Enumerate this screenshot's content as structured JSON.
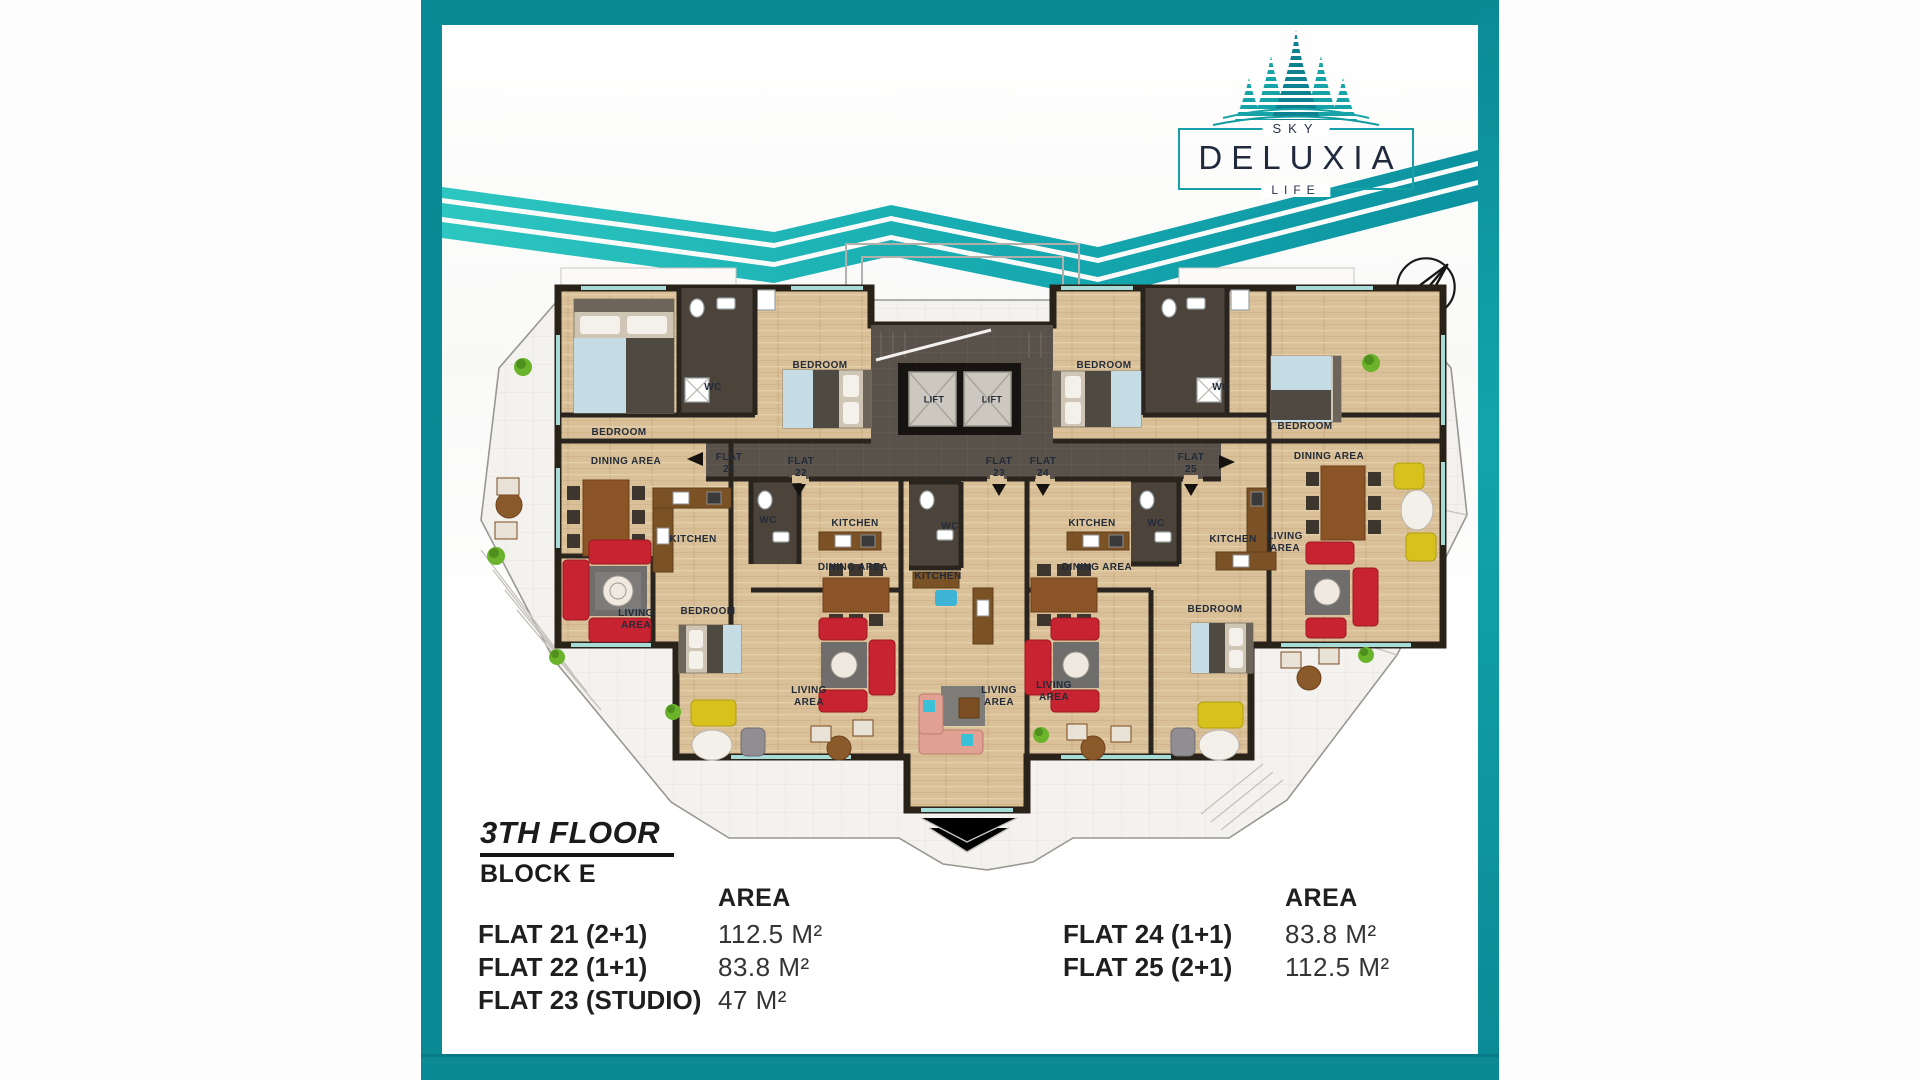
{
  "logo": {
    "sky": "SKY",
    "name": "DELUXIA",
    "life": "LIFE"
  },
  "floor_info": {
    "floor_label": "3TH FLOOR",
    "block_label": "BLOCK E"
  },
  "area_tables": {
    "left": {
      "header": "AREA",
      "rows": [
        {
          "flat": "FLAT 21 (2+1)",
          "area": "112.5 M²"
        },
        {
          "flat": "FLAT 22 (1+1)",
          "area": "83.8 M²"
        },
        {
          "flat": "FLAT 23 (STUDIO)",
          "area": "47 M²"
        }
      ]
    },
    "right": {
      "header": "AREA",
      "rows": [
        {
          "flat": "FLAT 24 (1+1)",
          "area": "83.8 M²"
        },
        {
          "flat": "FLAT 25 (2+1)",
          "area": "112.5 M²"
        }
      ]
    }
  },
  "colors": {
    "accent_teal": "#0b8a96",
    "wave_teal_light": "#2dc6c0",
    "wave_teal_dark": "#0c92a0",
    "logo_navy": "#202a3c",
    "wall": "#282218",
    "wood_floor": "#d9c098",
    "corridor": "#59524b",
    "terrace": "#f4f2ee",
    "sofa_red": "#c82330",
    "sofa_yellow": "#d6c11d",
    "bed_blue": "#c6dce4"
  },
  "plan": {
    "labels": [
      {
        "t": "BEDROOM",
        "x": 198,
        "y": 433
      },
      {
        "t": "WC",
        "x": 292,
        "y": 388
      },
      {
        "t": "BEDROOM",
        "x": 399,
        "y": 366
      },
      {
        "t": "LIFT",
        "x": 513,
        "y": 400,
        "s": 9
      },
      {
        "t": "LIFT",
        "x": 571,
        "y": 400,
        "s": 9
      },
      {
        "t": "BEDROOM",
        "x": 683,
        "y": 366
      },
      {
        "t": "WC",
        "x": 800,
        "y": 388
      },
      {
        "t": "BEDROOM",
        "x": 884,
        "y": 427
      },
      {
        "t": "FLAT\n21",
        "x": 308,
        "y": 464
      },
      {
        "t": "FLAT\n22",
        "x": 380,
        "y": 468
      },
      {
        "t": "FLAT\n23",
        "x": 578,
        "y": 468
      },
      {
        "t": "FLAT\n24",
        "x": 622,
        "y": 468
      },
      {
        "t": "FLAT\n25",
        "x": 770,
        "y": 464
      },
      {
        "t": "DINING AREA",
        "x": 205,
        "y": 462
      },
      {
        "t": "KITCHEN",
        "x": 272,
        "y": 540
      },
      {
        "t": "WC",
        "x": 347,
        "y": 521
      },
      {
        "t": "KITCHEN",
        "x": 434,
        "y": 524
      },
      {
        "t": "WC",
        "x": 529,
        "y": 527
      },
      {
        "t": "DINING AREA",
        "x": 432,
        "y": 568
      },
      {
        "t": "KITCHEN",
        "x": 517,
        "y": 577
      },
      {
        "t": "KITCHEN",
        "x": 671,
        "y": 524
      },
      {
        "t": "WC",
        "x": 735,
        "y": 524
      },
      {
        "t": "KITCHEN",
        "x": 812,
        "y": 540
      },
      {
        "t": "DINING AREA",
        "x": 676,
        "y": 568
      },
      {
        "t": "LIVING\nAREA",
        "x": 864,
        "y": 543
      },
      {
        "t": "DINING AREA",
        "x": 908,
        "y": 457
      },
      {
        "t": "LIVING\nAREA",
        "x": 215,
        "y": 620
      },
      {
        "t": "BEDROOM",
        "x": 287,
        "y": 612
      },
      {
        "t": "LIVING\nAREA",
        "x": 388,
        "y": 697
      },
      {
        "t": "LIVING\nAREA",
        "x": 578,
        "y": 697
      },
      {
        "t": "LIVING\nAREA",
        "x": 633,
        "y": 692
      },
      {
        "t": "BEDROOM",
        "x": 794,
        "y": 610
      }
    ]
  }
}
